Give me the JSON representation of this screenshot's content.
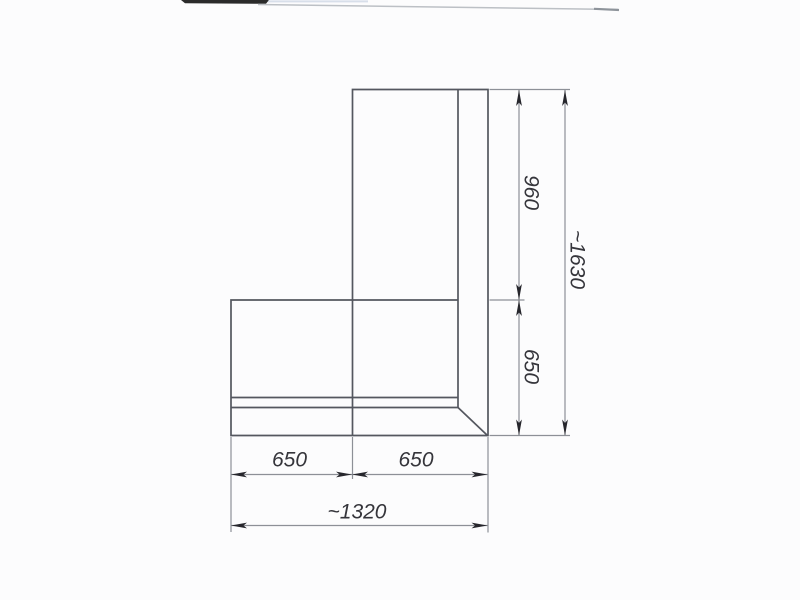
{
  "page": {
    "background_color": "#fcfcfd",
    "description": "Scanned dimensioned plan drawing of an L-shaped corner unit (corner sofa / worktop top view)"
  },
  "drawing": {
    "outline_color": "#54575f",
    "dimension_line_color": "#8d9097",
    "arrow_color": "#26262c",
    "text_color": "#35353b",
    "scan_artifact_bar_color": "#2b2b2b",
    "dimensions": {
      "upper_height": {
        "label": "960",
        "orientation": "vertical"
      },
      "total_height": {
        "label": "~1630",
        "orientation": "vertical"
      },
      "right_depth": {
        "label": "650",
        "orientation": "vertical"
      },
      "bottom_left_width": {
        "label": "650",
        "orientation": "horizontal"
      },
      "bottom_right_width": {
        "label": "650",
        "orientation": "horizontal"
      },
      "total_width": {
        "label": "~1320",
        "orientation": "horizontal"
      }
    }
  }
}
